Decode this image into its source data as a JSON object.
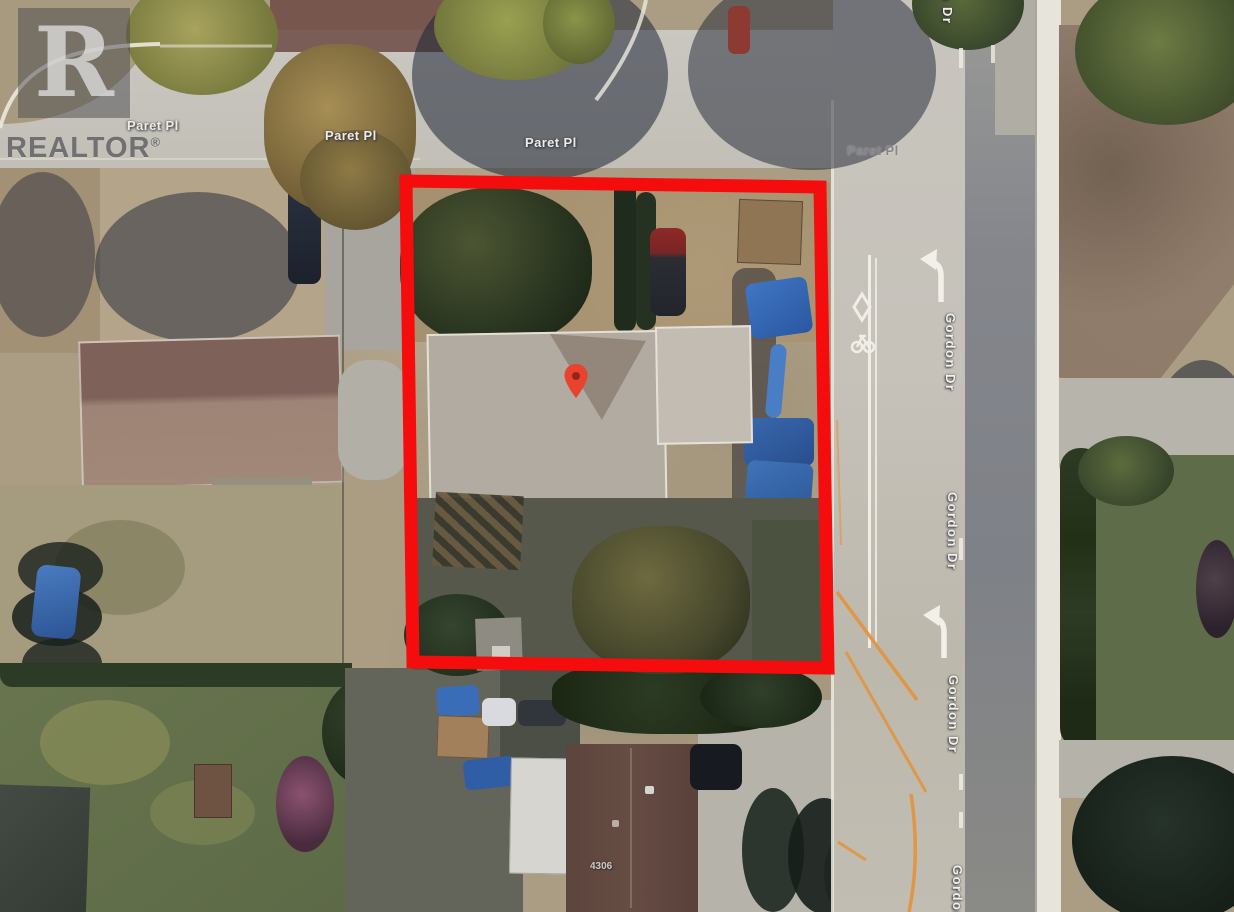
{
  "watermark": {
    "logo_letter": "R",
    "brand": "REALTOR",
    "registered_symbol": "®"
  },
  "streets": {
    "paret_pl_labels": [
      {
        "text": "Paret Pl"
      },
      {
        "text": "Paret Pl"
      },
      {
        "text": "Paret Pl"
      },
      {
        "text": "Paret Pl"
      }
    ],
    "gordon_dr_labels": [
      {
        "text": "Gordon Dr"
      },
      {
        "text": "Gordon Dr"
      },
      {
        "text": "Gordon Dr"
      },
      {
        "text": "Gordon Dr"
      },
      {
        "text": "Gordon Dr"
      }
    ]
  },
  "property": {
    "house_number": "4306",
    "boundary_color": "#F50D0D",
    "marker_color": "#E8432D",
    "marker_dot_color": "#96241B",
    "tarp_color": "#3565AC"
  }
}
